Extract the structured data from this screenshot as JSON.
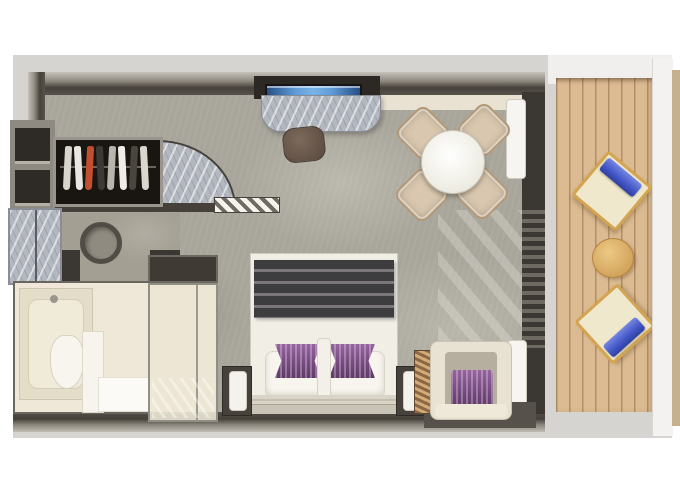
{
  "meta": {
    "type": "floor-plan",
    "subject": "suite-with-private-balcony",
    "text_visible": ""
  },
  "palette": {
    "background": "#d6d4d1",
    "carpet": "#a8a59b",
    "wall_dark": "#46423b",
    "marble": "#b3b7bf",
    "bathroom_cream": "#efe8d8",
    "bed_white": "#f1eee6",
    "blanket_dark": "#3d3c3e",
    "accent_purple": "#7c4e86",
    "tv_blue": "#5f9bd8",
    "deck_wood": "#dcbb92",
    "deck_frame_gold": "#d3a550",
    "towel_blue": "#4356c6",
    "chair_beige": "#d9c7af",
    "stool_brown": "#6f5d50"
  },
  "labels": {
    "plan": "suite floor plan",
    "entry": "entry door with swing arc",
    "wardrobe": "wardrobe with hanging clothes",
    "shelves": "open shelving",
    "cabinet": "marble cabinet",
    "sink": "round basin",
    "bathtub": "bathtub",
    "toilet": "toilet",
    "shower": "glass shower",
    "tv": "wall-mounted tv",
    "desk": "marble desk",
    "stool": "stool",
    "dining_table": "round dining table",
    "dining_chair": "dining chair",
    "bed": "king bed with purple accent pillows",
    "nightstand": "nightstand with lamp",
    "bench": "slatted bench",
    "armchair": "armchair with purple pillow",
    "curtain": "curtain",
    "window": "floor-to-ceiling window wall",
    "balcony": "private balcony deck",
    "deck_chair": "deck chair with blue towel",
    "deck_table": "round balcony table"
  },
  "wardrobe": {
    "garments": [
      "#d8d5cd",
      "#e9e7e1",
      "#c44f2e",
      "#3c3935",
      "#b8b5ad",
      "#efede7",
      "#4a463f",
      "#dad7cf"
    ]
  },
  "counts": {
    "dining_chairs": 4,
    "deck_chairs": 2,
    "nightstands": 2
  }
}
